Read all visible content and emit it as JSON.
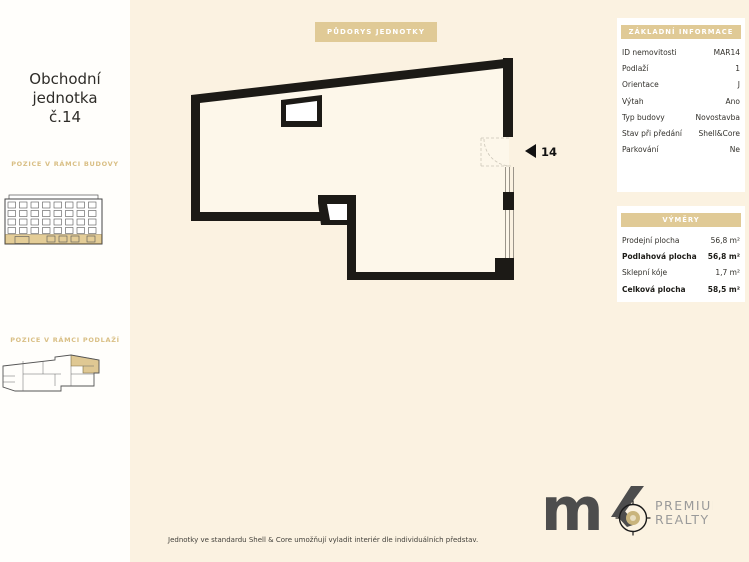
{
  "sidebar": {
    "title_lines": [
      "Obchodní",
      "jednotka",
      "č.14"
    ],
    "section1_label": "POZICE V RÁMCI BUDOVY",
    "section2_label": "POZICE V RÁMCI PODLAŽÍ"
  },
  "plan": {
    "badge": "PŮDORYS JEDNOTKY",
    "unit_number": "14"
  },
  "info_panel": {
    "title": "ZÁKLADNÍ INFORMACE",
    "rows": [
      {
        "label": "ID nemovitosti",
        "value": "MAR14"
      },
      {
        "label": "Podlaží",
        "value": "1"
      },
      {
        "label": "Orientace",
        "value": "J"
      },
      {
        "label": "Výtah",
        "value": "Ano"
      },
      {
        "label": "Typ budovy",
        "value": "Novostavba"
      },
      {
        "label": "Stav při předání",
        "value": "Shell&Core"
      },
      {
        "label": "Parkování",
        "value": "Ne"
      }
    ]
  },
  "area_panel": {
    "title": "VÝMĚRY",
    "rows": [
      {
        "label": "Prodejní plocha",
        "value": "56,8 m²"
      },
      {
        "label": "Podlahová plocha",
        "value": "56,8 m²"
      },
      {
        "label": "Sklepní kóje",
        "value": "1,7 m²"
      },
      {
        "label": "Celková plocha",
        "value": "58,5 m²"
      }
    ]
  },
  "footer": {
    "note": "Jednotky ve standardu Shell & Core umožňují vyladit interiér dle individuálních představ."
  },
  "logo": {
    "m": "m",
    "premium": "PREMIUM",
    "realty": "REALTY"
  },
  "colors": {
    "accent": "#e0ca96",
    "background": "#fbf2e1",
    "wall": "#1c1a16",
    "logo_gray": "#4d4d4d"
  }
}
